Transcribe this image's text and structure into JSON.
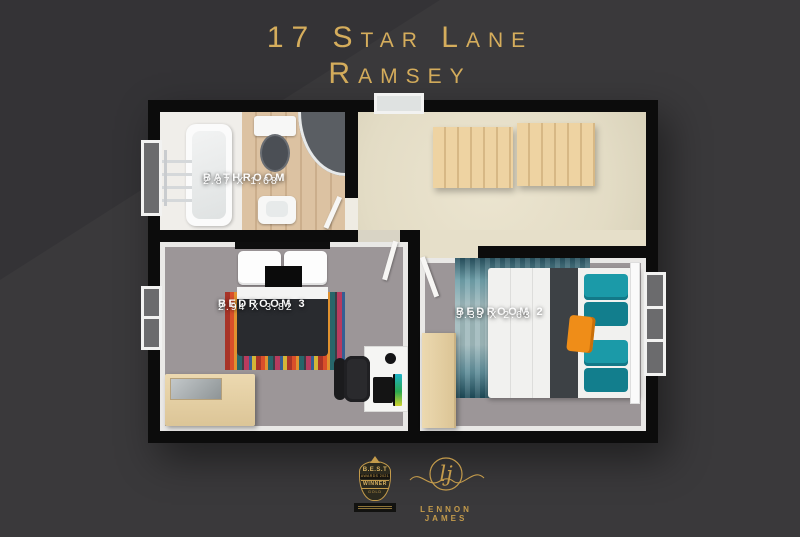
{
  "title": {
    "line1": "17 Star Lane",
    "line2": "Ramsey"
  },
  "floorplan": {
    "rooms": {
      "bathroom": {
        "name": "BATHROOM",
        "dimensions": "2.87 X 1.68"
      },
      "bedroom3": {
        "name": "BEDROOM 3",
        "dimensions": "2.94 X 3.82"
      },
      "bedroom2": {
        "name": "BEDROOM 2",
        "dimensions": "3.33 X 2.63"
      }
    }
  },
  "footer": {
    "award_badge": {
      "title": "B.E.S.T",
      "subtitle": "AWARDS 2021",
      "award": "WINNER",
      "level": "GOLD"
    },
    "brand": {
      "monogram": "lj",
      "name": "LENNON JAMES"
    }
  },
  "colors": {
    "background": "#3a393b",
    "gold_title": "#d5ad5c",
    "gold_footer": "#c49b4b",
    "wall": "#0c0c0c",
    "label_text": "#ffffff",
    "bathroom_wood_floor": "#d9bf9f",
    "landing_floor": "#e6dfc9",
    "bedroom_floor": "#9c9698",
    "stairs": "#eed3a2",
    "wood_furniture": "#e4cfa4",
    "duvet_dark": "#292b2f",
    "pillow_teal": "#1b9aa8",
    "cushion_orange": "#ef8d18",
    "rug_teal": "#2e6b7c"
  }
}
